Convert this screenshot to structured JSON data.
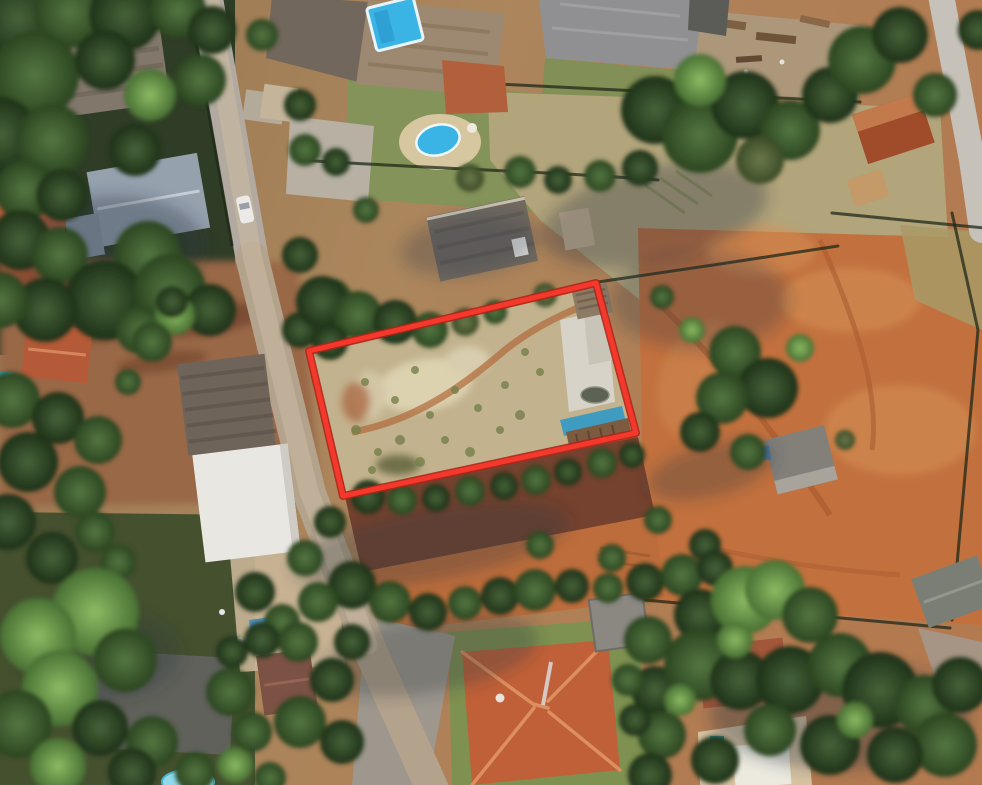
{
  "scene": {
    "type": "aerial-satellite-photo",
    "description": "Oblique aerial/satellite view of a suburban block with houses, pools, dirt roads, tree canopy, an orange dirt field, a warehouse with a white roof, and one vacant scrubland parcel highlighted with a red outline",
    "visible_text": []
  },
  "parcel": {
    "points": "309,351 596,283 636,433 343,496",
    "contents": "scrub ground, white concrete slab, small shed, dark pond, blue tarp structure"
  },
  "colors": {
    "parcel_outline": "#f4392c",
    "parcel_outline_edge": "#b02418",
    "pool_blue": "#3ab4e4",
    "pool_light": "#8fd9ea",
    "pool_teal": "#35989e",
    "roof_terracotta": "#b45a38",
    "roof_gray": "#909092",
    "roof_bluegray": "#96a1ae",
    "warehouse_white": "#e9e7e2",
    "dirt_orange": "#c2713e",
    "road_gray": "#b3a28c",
    "tree_dark": "#2b4423",
    "tree_bright": "#6fa04c",
    "lawn_green": "#84935a"
  },
  "features": {
    "highlighted_parcel": "vacant lot outlined in red",
    "landmarks": [
      "warehouse with white roof",
      "orange hip-roof house",
      "two blue swimming pools",
      "dirt road with white car",
      "orange dirt field",
      "dense tree canopy",
      "long terracotta outbuilding"
    ]
  }
}
